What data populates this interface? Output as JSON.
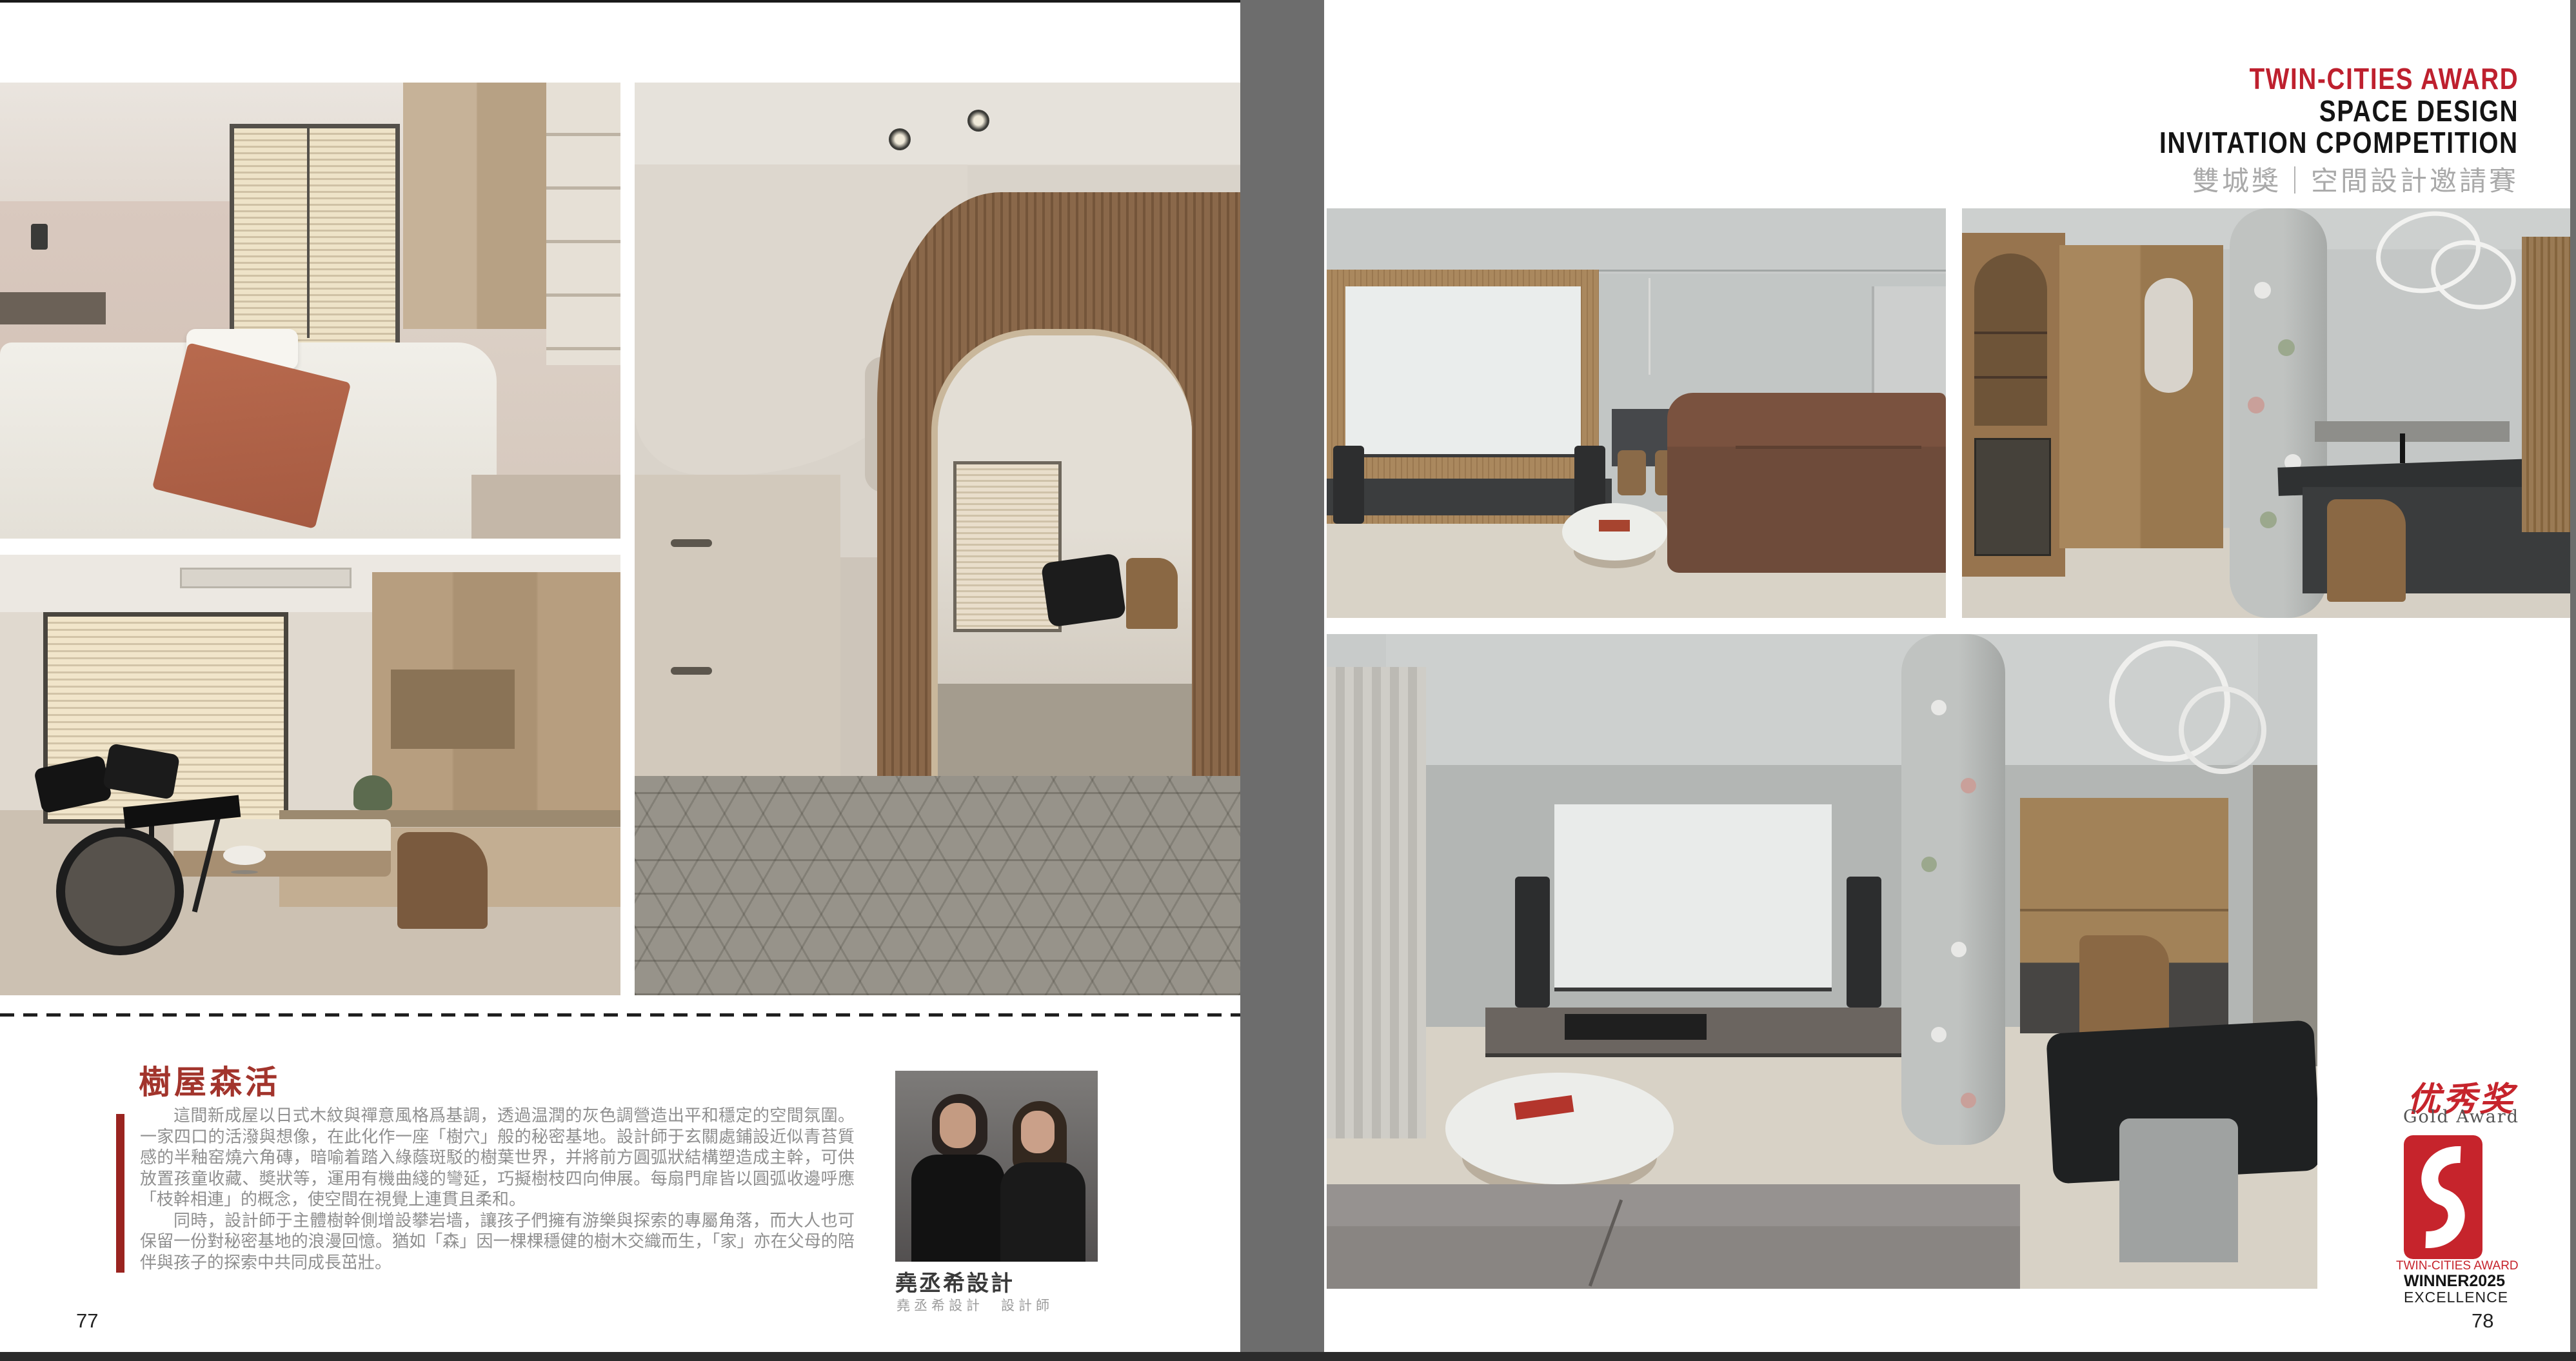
{
  "award_header": {
    "line1": "TWIN-CITIES AWARD",
    "line2": "SPACE DESIGN",
    "line3": "INVITATION CPOMPETITION",
    "line4": "雙城獎｜空間設計邀請賽",
    "accent_color": "#be202e",
    "subtitle_color": "#a9a9a9"
  },
  "article": {
    "title": "樹屋森活",
    "title_color": "#a2342c",
    "bar_color": "#9a2420",
    "paragraphs": [
      "這間新成屋以日式木紋與禪意風格爲基調，透過温潤的灰色調營造出平和穩定的空間氛圍。一家四口的活潑與想像，在此化作一座「樹穴」般的秘密基地。設計師于玄關處鋪設近似青苔質感的半釉窑燒六角磚，暗喻着踏入綠蔭斑駁的樹葉世界，并將前方圓弧狀結構塑造成主幹，可供放置孩童收藏、奬狀等，運用有機曲綫的彎延，巧擬樹枝四向伸展。每扇門扉皆以圓弧收邊呼應「枝幹相連」的概念，使空間在視覺上連貫且柔和。",
      "同時，設計師于主體樹幹側增設攀岩墙，讓孩子們擁有游樂與探索的專屬角落，而大人也可保留一份對秘密基地的浪漫回憶。猶如「森」因一棵棵穩健的樹木交織而生，「家」亦在父母的陪伴與孩子的探索中共同成長茁壯。"
    ]
  },
  "designer": {
    "name": "堯丞希設計",
    "credit": "堯丞希設計　設計師"
  },
  "award_badge": {
    "cn": "优秀奖",
    "en": "Gold Award",
    "line1": "TWIN-CITIES AWARD",
    "winner_label": "WINNER",
    "winner_year": "2025",
    "line3": "EXCELLENCE",
    "red": "#c6242c"
  },
  "pages": {
    "left_number": "77",
    "right_number": "78"
  }
}
